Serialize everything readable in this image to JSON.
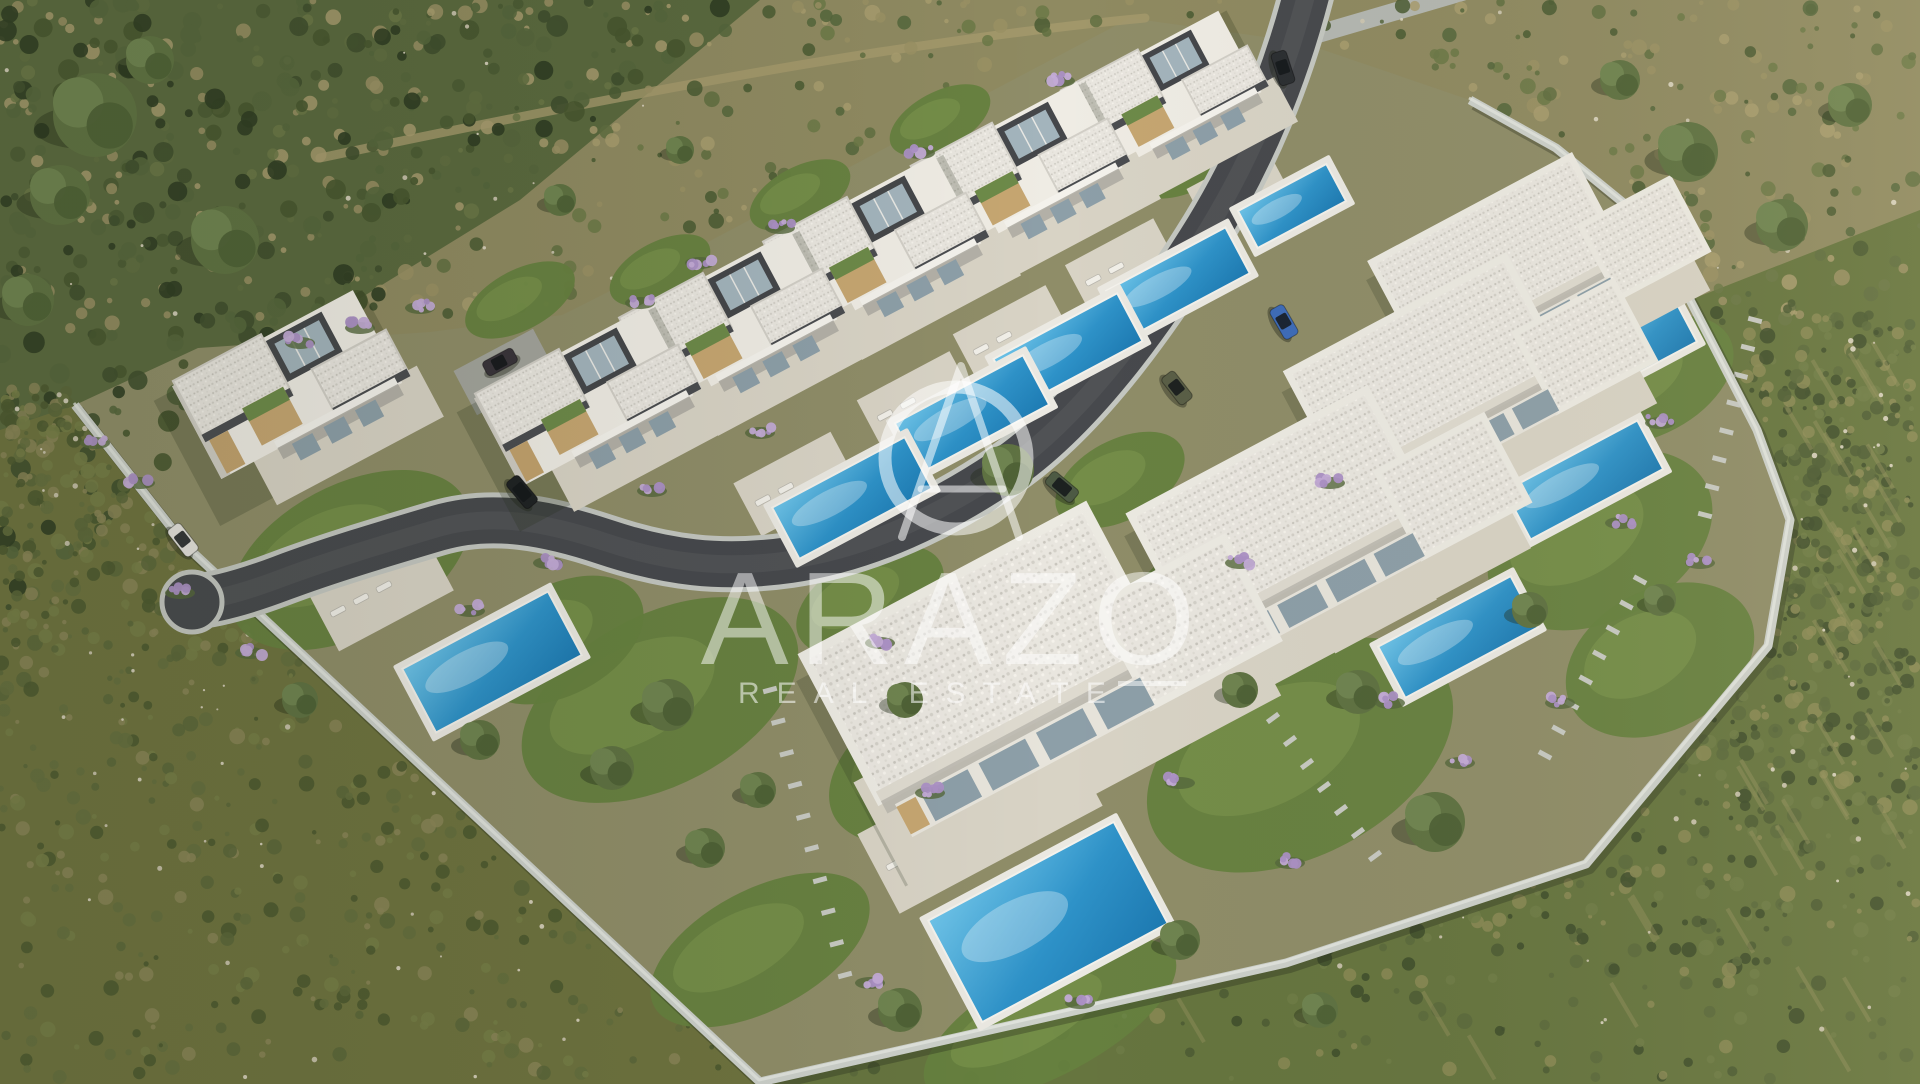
{
  "watermark": {
    "brand": "ARAZO",
    "tagline": "REAL ESTATE",
    "logo_name": "arazo-a-monogram-logo",
    "color": "rgba(255,255,255,0.52)"
  },
  "colors": {
    "scrub_base": "#8f8a61",
    "brush_dark": "#5a693e",
    "hill_green": "#66753f",
    "field_olive": "#6e733f",
    "site_ground": "#8f8d68",
    "dirt": "#a59a6d",
    "asphalt": "#47494d",
    "asphalt_worn": "#5a5d60",
    "curb": "#c4c7c1",
    "wall": "#ccd0ca",
    "wall_shadow": "rgba(40,45,30,0.35)",
    "terrace": "#d8d3c5",
    "lawn": "#66813f",
    "lawn_light": "#7f9a50",
    "gravel_roof": "#e9e6df",
    "fascia_dark": "#4b4d50",
    "villa_white": "#efece4",
    "villa_shade": "#cfccc3",
    "glass": "#a3b4bc",
    "glass_dark": "#8d9fa8",
    "wood": "#c6a671",
    "pergola_green": "#6d8a49",
    "pool_deck": "#ebe9e2",
    "pool_light": "#6ec4e9",
    "pool_mid": "#2e92c8",
    "pool_deep": "#1d7ab2",
    "lavender": "#ab90c4",
    "lavender_light": "#c3abd6",
    "tree_green": "#5f7242",
    "tree_dark": "#4e6136",
    "tree_light": "#6f8450",
    "stone": "#cdc6b1",
    "shadow": "rgba(36,46,25,0.4)"
  },
  "scene": {
    "rotation_deg": -28,
    "site_boundary": [
      [
        1130,
        18
      ],
      [
        990,
        92
      ],
      [
        848,
        168
      ],
      [
        706,
        243
      ],
      [
        562,
        315
      ],
      [
        430,
        332
      ],
      [
        198,
        348
      ],
      [
        75,
        405
      ],
      [
        185,
        545
      ],
      [
        760,
        1082
      ],
      [
        1286,
        963
      ],
      [
        1586,
        864
      ],
      [
        1768,
        646
      ],
      [
        1790,
        520
      ],
      [
        1757,
        430
      ],
      [
        1690,
        300
      ],
      [
        1637,
        214
      ],
      [
        1556,
        148
      ],
      [
        1470,
        100
      ],
      [
        1300,
        42
      ]
    ],
    "wall_line": [
      [
        75,
        405
      ],
      [
        185,
        545
      ],
      [
        760,
        1082
      ],
      [
        1286,
        963
      ],
      [
        1586,
        864
      ],
      [
        1768,
        646
      ],
      [
        1790,
        520
      ],
      [
        1757,
        430
      ],
      [
        1690,
        300
      ],
      [
        1637,
        214
      ],
      [
        1556,
        148
      ],
      [
        1470,
        100
      ]
    ],
    "road_main": "M 1310,-20 C 1288,70 1252,160 1200,242 C 1148,324 1080,420 1002,472 C 930,520 860,550 790,560 C 720,570 665,562 605,542 C 548,523 492,512 438,528 C 384,544 330,560 282,578 C 245,592 215,600 192,602",
    "road_entry": "M 1462,-8 L 1318,34",
    "dirt_track": "M 320,158 C 500,120 700,80 880,52 C 980,37 1060,26 1145,18",
    "villas": [
      {
        "type": "two",
        "x": 1172,
        "y": 100,
        "s": 0.92
      },
      {
        "type": "two",
        "x": 1028,
        "y": 176,
        "s": 0.97
      },
      {
        "type": "two",
        "x": 884,
        "y": 252,
        "s": 1.0
      },
      {
        "type": "two",
        "x": 740,
        "y": 328,
        "s": 1.0
      },
      {
        "type": "two",
        "x": 596,
        "y": 404,
        "s": 1.0
      },
      {
        "type": "two",
        "x": 300,
        "y": 392,
        "s": 1.05
      },
      {
        "type": "one",
        "x": 1525,
        "y": 258,
        "s": 1.1
      },
      {
        "type": "one",
        "x": 1455,
        "y": 368,
        "s": 1.2
      },
      {
        "type": "one",
        "x": 1312,
        "y": 510,
        "s": 1.3
      },
      {
        "type": "one",
        "x": 1020,
        "y": 650,
        "s": 1.55
      }
    ],
    "pools": [
      {
        "x": 1292,
        "y": 206,
        "w": 100,
        "h": 42
      },
      {
        "x": 1178,
        "y": 282,
        "w": 135,
        "h": 52
      },
      {
        "x": 1068,
        "y": 350,
        "w": 140,
        "h": 54
      },
      {
        "x": 972,
        "y": 414,
        "w": 145,
        "h": 56
      },
      {
        "x": 852,
        "y": 498,
        "w": 150,
        "h": 58
      },
      {
        "x": 492,
        "y": 662,
        "w": 165,
        "h": 72
      },
      {
        "x": 1048,
        "y": 922,
        "w": 210,
        "h": 115
      },
      {
        "x": 1634,
        "y": 349,
        "w": 118,
        "h": 46
      },
      {
        "x": 1584,
        "y": 480,
        "w": 150,
        "h": 55
      },
      {
        "x": 1458,
        "y": 637,
        "w": 150,
        "h": 58
      }
    ],
    "terraces": [
      {
        "x": 1238,
        "y": 190,
        "w": 90,
        "h": 50,
        "table": false
      },
      {
        "x": 1122,
        "y": 266,
        "w": 100,
        "h": 55,
        "table": false
      },
      {
        "x": 1012,
        "y": 334,
        "w": 105,
        "h": 55,
        "table": false
      },
      {
        "x": 916,
        "y": 400,
        "w": 105,
        "h": 55,
        "table": false
      },
      {
        "x": 796,
        "y": 484,
        "w": 110,
        "h": 60,
        "table": false
      },
      {
        "x": 380,
        "y": 590,
        "w": 130,
        "h": 70,
        "table": false
      },
      {
        "x": 980,
        "y": 820,
        "w": 230,
        "h": 90,
        "table": true
      },
      {
        "x": 1560,
        "y": 320,
        "w": 100,
        "h": 60,
        "table": true
      },
      {
        "x": 1500,
        "y": 445,
        "w": 110,
        "h": 60,
        "table": true
      },
      {
        "x": 1372,
        "y": 600,
        "w": 115,
        "h": 60,
        "table": true
      }
    ],
    "lawns": [
      [
        660,
        700,
        150,
        85
      ],
      [
        940,
        760,
        120,
        70
      ],
      [
        1300,
        755,
        165,
        100
      ],
      [
        1600,
        540,
        120,
        80
      ],
      [
        1660,
        660,
        100,
        70
      ],
      [
        350,
        560,
        130,
        75
      ],
      [
        560,
        640,
        90,
        55
      ],
      [
        1210,
        600,
        90,
        60
      ],
      [
        1430,
        450,
        80,
        50
      ],
      [
        870,
        600,
        80,
        45
      ],
      [
        1120,
        480,
        70,
        40
      ],
      [
        520,
        300,
        60,
        30
      ],
      [
        660,
        270,
        55,
        28
      ],
      [
        800,
        195,
        55,
        28
      ],
      [
        940,
        120,
        55,
        28
      ],
      [
        1190,
        160,
        60,
        30
      ],
      [
        760,
        950,
        120,
        60
      ],
      [
        1050,
        1020,
        140,
        55
      ],
      [
        1650,
        380,
        90,
        55
      ]
    ],
    "trees": [
      [
        95,
        115,
        42
      ],
      [
        60,
        195,
        30
      ],
      [
        225,
        240,
        34
      ],
      [
        28,
        300,
        26
      ],
      [
        150,
        60,
        24
      ],
      [
        1688,
        152,
        30
      ],
      [
        1782,
        225,
        26
      ],
      [
        1850,
        105,
        22
      ],
      [
        1620,
        80,
        20
      ],
      [
        1008,
        470,
        26
      ],
      [
        1435,
        822,
        30
      ],
      [
        1358,
        692,
        22
      ],
      [
        668,
        705,
        26
      ],
      [
        612,
        768,
        22
      ],
      [
        705,
        848,
        20
      ],
      [
        758,
        790,
        18
      ],
      [
        905,
        700,
        18
      ],
      [
        1240,
        690,
        18
      ],
      [
        1530,
        610,
        18
      ],
      [
        1660,
        600,
        16
      ],
      [
        480,
        740,
        20
      ],
      [
        300,
        700,
        18
      ],
      [
        1180,
        940,
        20
      ],
      [
        900,
        1010,
        22
      ],
      [
        1320,
        1010,
        18
      ],
      [
        560,
        200,
        16
      ],
      [
        680,
        150,
        14
      ]
    ],
    "lavender": [
      [
        420,
        305
      ],
      [
        360,
        325
      ],
      [
        300,
        340
      ],
      [
        640,
        300
      ],
      [
        700,
        260
      ],
      [
        780,
        225
      ],
      [
        920,
        150
      ],
      [
        1060,
        78
      ],
      [
        760,
        430
      ],
      [
        652,
        488
      ],
      [
        548,
        560
      ],
      [
        470,
        608
      ],
      [
        250,
        650
      ],
      [
        180,
        590
      ],
      [
        880,
        640
      ],
      [
        930,
        790
      ],
      [
        1080,
        1000
      ],
      [
        870,
        980
      ],
      [
        1180,
        780
      ],
      [
        1290,
        860
      ],
      [
        1390,
        700
      ],
      [
        1330,
        480
      ],
      [
        1240,
        560
      ],
      [
        1660,
        420
      ],
      [
        1700,
        560
      ],
      [
        1620,
        520
      ],
      [
        1560,
        700
      ],
      [
        1460,
        760
      ],
      [
        140,
        480
      ],
      [
        95,
        440
      ]
    ],
    "stepping_paths": [
      {
        "from": [
          770,
          690
        ],
        "to": [
          845,
          975
        ],
        "n": 10
      },
      {
        "from": [
          1640,
          580
        ],
        "to": [
          1545,
          755
        ],
        "n": 8
      },
      {
        "from": [
          1755,
          320
        ],
        "to": [
          1705,
          515
        ],
        "n": 8
      },
      {
        "from": [
          1273,
          718
        ],
        "to": [
          1375,
          856
        ],
        "n": 7
      },
      {
        "from": [
          1213,
          492
        ],
        "to": [
          1298,
          618
        ],
        "n": 6
      }
    ],
    "cars": [
      {
        "x": 1284,
        "y": 322,
        "rot": 60,
        "color": "#3e6cb8",
        "name": "car-blue"
      },
      {
        "x": 1177,
        "y": 388,
        "rot": 52,
        "color": "#5a5f47",
        "name": "car-olive"
      },
      {
        "x": 1062,
        "y": 487,
        "rot": 40,
        "color": "#4d5a44",
        "suv": true,
        "name": "suv-green"
      },
      {
        "x": 1283,
        "y": 68,
        "rot": 72,
        "color": "#2c2f32",
        "name": "car-dark"
      },
      {
        "x": 500,
        "y": 362,
        "rot": -28,
        "color": "#39343a",
        "name": "pickup-dark"
      },
      {
        "x": 522,
        "y": 492,
        "rot": 50,
        "color": "#1f2224",
        "suv": true,
        "name": "suv-black"
      },
      {
        "x": 183,
        "y": 540,
        "rot": 52,
        "color": "#e6e4de",
        "name": "car-white"
      }
    ]
  }
}
